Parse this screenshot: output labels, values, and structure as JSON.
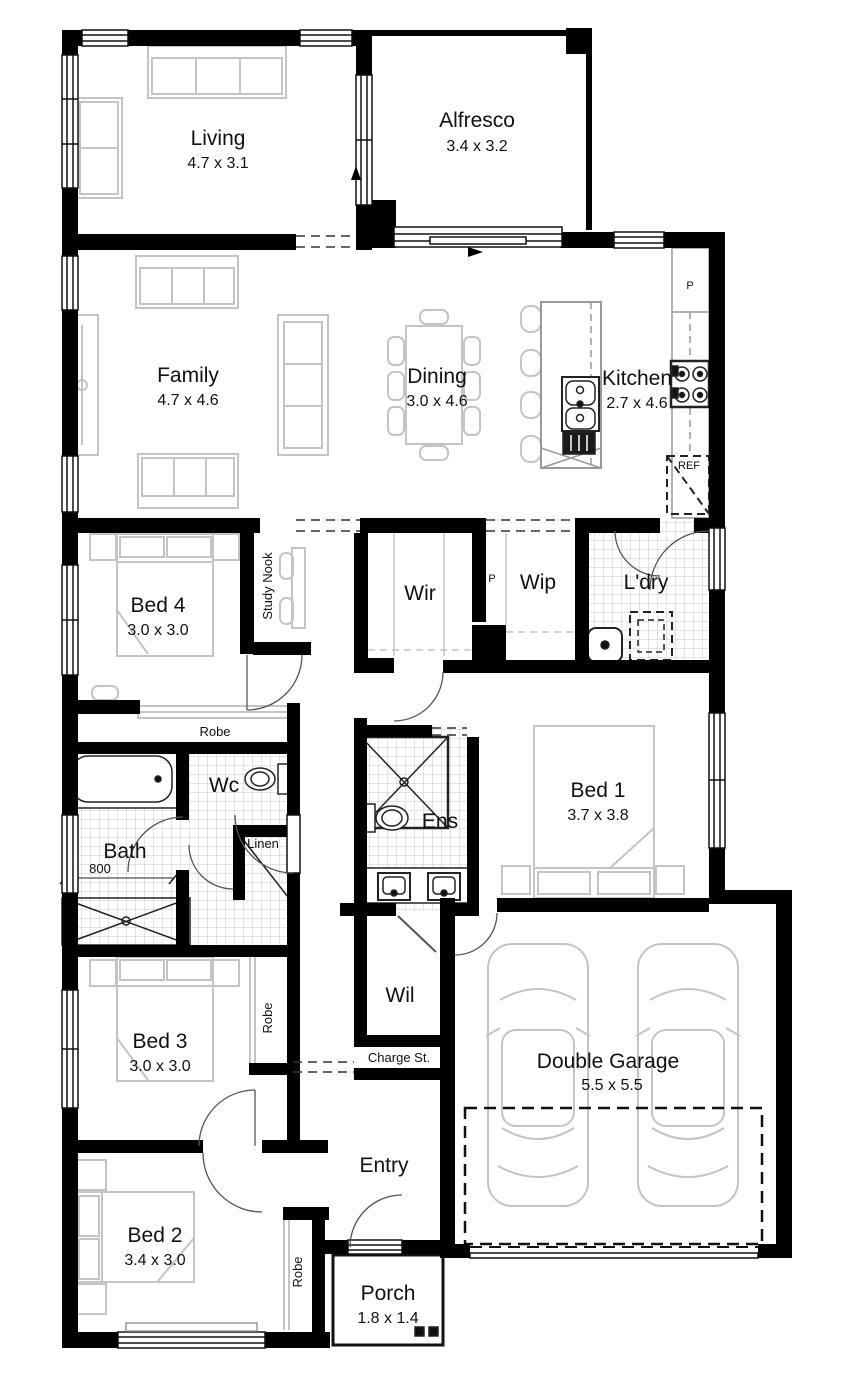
{
  "colors": {
    "wall": "#000000",
    "furniture": "#c4c4c4",
    "tile": "#c9c9c9",
    "arc": "#555555"
  },
  "rooms": {
    "living": {
      "name": "Living",
      "dims": "4.7 x 3.1"
    },
    "alfresco": {
      "name": "Alfresco",
      "dims": "3.4 x 3.2"
    },
    "family": {
      "name": "Family",
      "dims": "4.7 x 4.6"
    },
    "dining": {
      "name": "Dining",
      "dims": "3.0 x 4.6"
    },
    "kitchen": {
      "name": "Kitchen",
      "dims": "2.7 x 4.6"
    },
    "bed4": {
      "name": "Bed 4",
      "dims": "3.0 x 3.0"
    },
    "wir": {
      "name": "Wir"
    },
    "wip": {
      "name": "Wip"
    },
    "ldry": {
      "name": "L'dry"
    },
    "bath": {
      "name": "Bath"
    },
    "wc": {
      "name": "Wc"
    },
    "ens": {
      "name": "Ens"
    },
    "bed1": {
      "name": "Bed 1",
      "dims": "3.7 x 3.8"
    },
    "bed3": {
      "name": "Bed 3",
      "dims": "3.0 x 3.0"
    },
    "wil": {
      "name": "Wil"
    },
    "garage": {
      "name": "Double Garage",
      "dims": "5.5 x 5.5"
    },
    "entry": {
      "name": "Entry"
    },
    "bed2": {
      "name": "Bed 2",
      "dims": "3.4 x 3.0"
    },
    "porch": {
      "name": "Porch",
      "dims": "1.8 x 1.4"
    }
  },
  "labels": {
    "study_nook": "Study Nook",
    "robe_bed4": "Robe",
    "robe_bed3": "Robe",
    "robe_bed2": "Robe",
    "linen": "Linen",
    "charge_st": "Charge St.",
    "pantry_p": "P",
    "wip_p": "P",
    "fridge": "REF",
    "shower_dim": "800"
  }
}
